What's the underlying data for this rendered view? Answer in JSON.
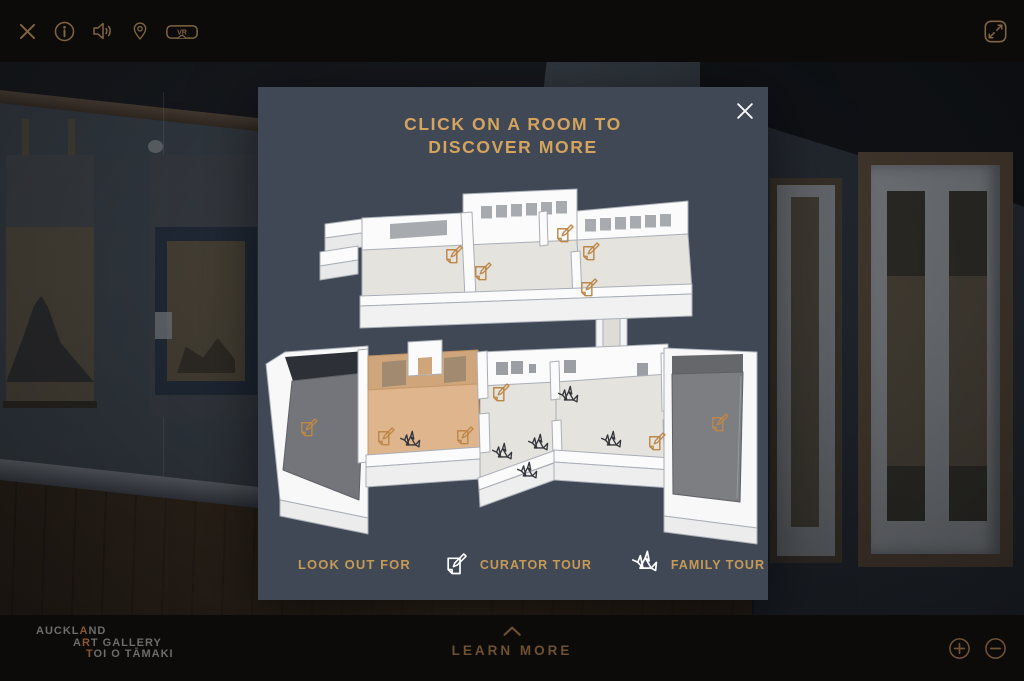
{
  "toolbar": {
    "vr_badge": "VR",
    "icons": [
      "close-icon",
      "info-icon",
      "audio-icon",
      "location-pin-icon",
      "vr-headset-icon",
      "fullscreen-icon"
    ]
  },
  "modal": {
    "title_line1": "CLICK ON A ROOM TO",
    "title_line2": "DISCOVER MORE",
    "legend": {
      "heading": "LOOK OUT FOR",
      "curator_label": "CURATOR TOUR",
      "family_label": "FAMILY TOUR"
    },
    "map": {
      "curator_stops": [
        {
          "x": 453,
          "y": 255
        },
        {
          "x": 482,
          "y": 272
        },
        {
          "x": 564,
          "y": 234
        },
        {
          "x": 590,
          "y": 252
        },
        {
          "x": 588,
          "y": 288
        },
        {
          "x": 308,
          "y": 428
        },
        {
          "x": 385,
          "y": 437
        },
        {
          "x": 464,
          "y": 436
        },
        {
          "x": 500,
          "y": 393
        },
        {
          "x": 656,
          "y": 442
        },
        {
          "x": 719,
          "y": 423
        }
      ],
      "family_stops": [
        {
          "x": 410,
          "y": 442
        },
        {
          "x": 568,
          "y": 397
        },
        {
          "x": 502,
          "y": 454
        },
        {
          "x": 538,
          "y": 445
        },
        {
          "x": 527,
          "y": 473
        },
        {
          "x": 611,
          "y": 442
        }
      ]
    }
  },
  "footer": {
    "learn_more": "LEARN MORE",
    "logo": {
      "l1_pre": "AUCKL",
      "l1_hi": "A",
      "l1_post": "ND",
      "l2_pre": "A",
      "l2_hi": "R",
      "l2_post": "T GALLERY",
      "l3_hi": "T",
      "l3_post": "OI O TĀMAKI"
    }
  },
  "colors": {
    "toolbar_icon": "#8a6c48",
    "modal_bg": "#404856",
    "title_text": "#d4a35e",
    "legend_text": "#c59a55",
    "footer_text": "#6e5132",
    "logo_gray": "#6c6c6c",
    "logo_accent": "#8a5730",
    "plan_wall": "#fbfbfb",
    "plan_floor": "#e5e3de",
    "plan_dark_floor": "#74757a",
    "highlight_room_floor": "#dfb58d",
    "highlight_room_wall": "#cfa67c",
    "curator_icon": "#bd8748",
    "family_icon": "#33353b",
    "legend_icon": "#ffffff"
  }
}
